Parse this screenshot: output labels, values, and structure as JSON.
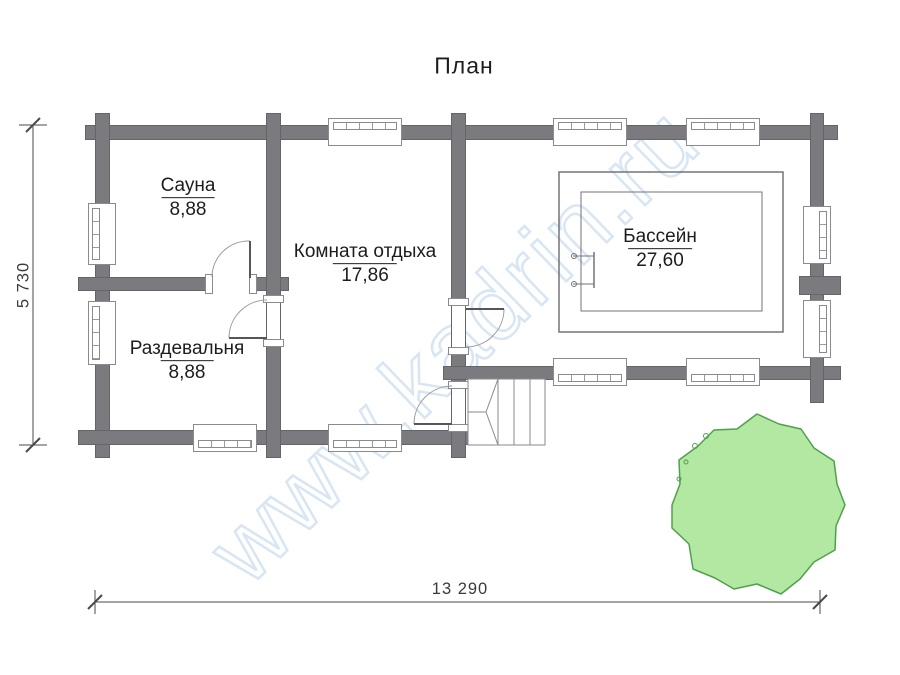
{
  "title": "План",
  "watermark": "www.kadrin.ru",
  "rooms": [
    {
      "name": "Сауна",
      "area": "8,88"
    },
    {
      "name": "Комната отдыха",
      "area": "17,86"
    },
    {
      "name": "Раздевальня",
      "area": "8,88"
    },
    {
      "name": "Бассейн",
      "area": "27,60"
    }
  ],
  "dimensions": {
    "width_label": "13 290",
    "height_label": "5 730"
  },
  "colors": {
    "wall": "#7a7a7f",
    "tree_fill": "#b2e8a2",
    "tree_stroke": "#50a04b",
    "watermark": "#d8e6f3"
  }
}
